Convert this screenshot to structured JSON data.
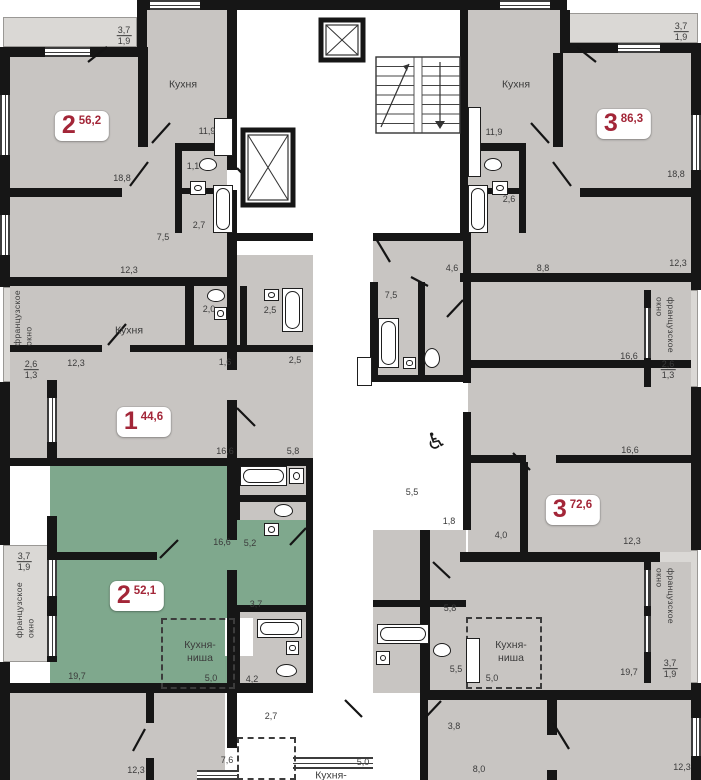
{
  "plan": {
    "type": "residential-floor-plan",
    "language": "ru",
    "width": 701,
    "height": 780
  },
  "colors": {
    "wall": "#161616",
    "floor_gray": "#c8c5c2",
    "floor_green": "#7fa88d",
    "balcony": "#dad8d5",
    "corridor": "#ffffff",
    "label_text": "#3b3b3b",
    "apartment_red": "#a32638"
  },
  "badges": [
    {
      "num": "2",
      "area": "56,2",
      "x": 82,
      "y": 126
    },
    {
      "num": "3",
      "area": "86,3",
      "x": 624,
      "y": 124
    },
    {
      "num": "1",
      "area": "44,6",
      "x": 144,
      "y": 422
    },
    {
      "num": "3",
      "area": "72,6",
      "x": 573,
      "y": 510
    },
    {
      "num": "2",
      "area": "52,1",
      "x": 137,
      "y": 596
    }
  ],
  "rooms": [
    {
      "t": "Кухня",
      "x": 183,
      "y": 85
    },
    {
      "t": "Кухня",
      "x": 516,
      "y": 85
    },
    {
      "t": "Кухня",
      "x": 129,
      "y": 331
    },
    {
      "t": "Кухня-\nниша",
      "x": 200,
      "y": 652
    },
    {
      "t": "Кухня-\nниша",
      "x": 511,
      "y": 652
    },
    {
      "t": "Кухня-",
      "x": 331,
      "y": 776
    }
  ],
  "dims": [
    {
      "t": "11,9",
      "x": 207,
      "y": 131
    },
    {
      "t": "18,8",
      "x": 122,
      "y": 178
    },
    {
      "t": "1,1",
      "x": 193,
      "y": 166
    },
    {
      "t": "2,7",
      "x": 199,
      "y": 225
    },
    {
      "t": "7,5",
      "x": 163,
      "y": 237
    },
    {
      "t": "12,3",
      "x": 129,
      "y": 270
    },
    {
      "t": "11,9",
      "x": 494,
      "y": 132
    },
    {
      "t": "18,8",
      "x": 676,
      "y": 174
    },
    {
      "t": "2,6",
      "x": 509,
      "y": 199
    },
    {
      "t": "12,3",
      "x": 678,
      "y": 263
    },
    {
      "t": "8,8",
      "x": 543,
      "y": 268
    },
    {
      "t": "4,6",
      "x": 452,
      "y": 268
    },
    {
      "t": "12,3",
      "x": 76,
      "y": 363
    },
    {
      "t": "2,0",
      "x": 209,
      "y": 309
    },
    {
      "t": "1,6",
      "x": 225,
      "y": 362
    },
    {
      "t": "2,5",
      "x": 270,
      "y": 310
    },
    {
      "t": "2,5",
      "x": 295,
      "y": 360
    },
    {
      "t": "16,6",
      "x": 225,
      "y": 451
    },
    {
      "t": "5,8",
      "x": 293,
      "y": 451
    },
    {
      "t": "16,6",
      "x": 629,
      "y": 356
    },
    {
      "t": "16,6",
      "x": 630,
      "y": 450
    },
    {
      "t": "7,5",
      "x": 391,
      "y": 295
    },
    {
      "t": "5,5",
      "x": 412,
      "y": 492
    },
    {
      "t": "1,8",
      "x": 449,
      "y": 521
    },
    {
      "t": "4,0",
      "x": 501,
      "y": 535
    },
    {
      "t": "12,3",
      "x": 632,
      "y": 541
    },
    {
      "t": "16,6",
      "x": 222,
      "y": 542
    },
    {
      "t": "19,7",
      "x": 77,
      "y": 676
    },
    {
      "t": "5,0",
      "x": 211,
      "y": 678
    },
    {
      "t": "5,2",
      "x": 250,
      "y": 543
    },
    {
      "t": "3,7",
      "x": 256,
      "y": 604
    },
    {
      "t": "4,2",
      "x": 252,
      "y": 679
    },
    {
      "t": "2,7",
      "x": 271,
      "y": 716
    },
    {
      "t": "5,8",
      "x": 450,
      "y": 608
    },
    {
      "t": "5,5",
      "x": 456,
      "y": 669
    },
    {
      "t": "19,7",
      "x": 629,
      "y": 672
    },
    {
      "t": "5,0",
      "x": 492,
      "y": 678
    },
    {
      "t": "3,8",
      "x": 454,
      "y": 726
    },
    {
      "t": "12,3",
      "x": 136,
      "y": 770
    },
    {
      "t": "7,6",
      "x": 227,
      "y": 760
    },
    {
      "t": "5,0",
      "x": 363,
      "y": 762
    },
    {
      "t": "8,0",
      "x": 479,
      "y": 769
    },
    {
      "t": "12,3",
      "x": 682,
      "y": 767
    }
  ],
  "fractions": [
    {
      "top": "3,7",
      "bot": "1,9",
      "x": 124,
      "y": 36
    },
    {
      "top": "3,7",
      "bot": "1,9",
      "x": 681,
      "y": 32
    },
    {
      "top": "2,6",
      "bot": "1,3",
      "x": 31,
      "y": 370
    },
    {
      "top": "2,6",
      "bot": "1,3",
      "x": 668,
      "y": 370
    },
    {
      "top": "3,7",
      "bot": "1,9",
      "x": 24,
      "y": 562
    },
    {
      "top": "3,7",
      "bot": "1,9",
      "x": 670,
      "y": 669
    }
  ],
  "vtexts": [
    {
      "t": "французское\nокно",
      "x": 12,
      "y": 290,
      "dir": "up"
    },
    {
      "t": "французское\nокно",
      "x": 14,
      "y": 582,
      "dir": "up"
    },
    {
      "t": "французское\nокно",
      "x": 653,
      "y": 297,
      "dir": "down"
    },
    {
      "t": "французское\nокно",
      "x": 653,
      "y": 568,
      "dir": "down"
    }
  ],
  "icons": [
    {
      "name": "wheelchair-icon",
      "glyph": "♿",
      "x": 436,
      "y": 441
    }
  ],
  "geometry": {
    "balconies": [
      [
        3,
        17,
        134,
        30
      ],
      [
        565,
        13,
        133,
        30
      ],
      [
        3,
        287,
        47,
        95
      ],
      [
        3,
        545,
        47,
        117
      ],
      [
        651,
        290,
        47,
        97
      ],
      [
        651,
        550,
        47,
        133
      ]
    ],
    "floors": [
      {
        "c": "g",
        "r": [
          10,
          47,
          217,
          230
        ]
      },
      {
        "c": "g",
        "r": [
          137,
          10,
          96,
          40
        ]
      },
      {
        "c": "g",
        "r": [
          466,
          10,
          96,
          43
        ]
      },
      {
        "c": "g",
        "r": [
          466,
          53,
          225,
          224
        ]
      },
      {
        "c": "g",
        "r": [
          10,
          286,
          303,
          172
        ]
      },
      {
        "c": "g",
        "r": [
          237,
          255,
          76,
          31
        ]
      },
      {
        "c": "g",
        "r": [
          468,
          282,
          223,
          270
        ]
      },
      {
        "c": "g",
        "r": [
          373,
          241,
          93,
          141
        ]
      },
      {
        "c": "g",
        "r": [
          373,
          530,
          93,
          163
        ]
      },
      {
        "c": "g",
        "r": [
          233,
          460,
          80,
          60
        ]
      },
      {
        "c": "g",
        "r": [
          233,
          612,
          77,
          71
        ]
      },
      {
        "c": "g",
        "r": [
          428,
          562,
          263,
          128
        ]
      },
      {
        "c": "g",
        "r": [
          10,
          693,
          217,
          87
        ]
      },
      {
        "c": "g",
        "r": [
          428,
          700,
          263,
          80
        ]
      },
      {
        "c": "n",
        "r": [
          50,
          465,
          183,
          218
        ]
      },
      {
        "c": "n",
        "r": [
          233,
          520,
          77,
          92
        ]
      },
      {
        "c": "w",
        "r": [
          233,
          10,
          227,
          223
        ]
      },
      {
        "c": "w",
        "r": [
          313,
          233,
          60,
          460
        ]
      },
      {
        "c": "w",
        "r": [
          345,
          382,
          118,
          148
        ]
      },
      {
        "c": "w",
        "r": [
          225,
          693,
          203,
          87
        ]
      },
      {
        "c": "w",
        "r": [
          225,
          618,
          28,
          38
        ]
      }
    ],
    "walls": [
      [
        0,
        47,
        10,
        240
      ],
      [
        0,
        382,
        10,
        163
      ],
      [
        0,
        662,
        10,
        118
      ],
      [
        0,
        47,
        140,
        10
      ],
      [
        137,
        10,
        10,
        47
      ],
      [
        137,
        0,
        430,
        10
      ],
      [
        560,
        10,
        10,
        43
      ],
      [
        560,
        43,
        141,
        10
      ],
      [
        691,
        43,
        10,
        247
      ],
      [
        691,
        387,
        10,
        163
      ],
      [
        691,
        683,
        10,
        97
      ],
      [
        227,
        10,
        10,
        160
      ],
      [
        227,
        190,
        10,
        180
      ],
      [
        227,
        400,
        10,
        140
      ],
      [
        227,
        570,
        10,
        123
      ],
      [
        227,
        693,
        10,
        55
      ],
      [
        460,
        10,
        8,
        223
      ],
      [
        463,
        233,
        8,
        150
      ],
      [
        463,
        412,
        8,
        118
      ],
      [
        420,
        530,
        10,
        163
      ],
      [
        420,
        693,
        8,
        87
      ],
      [
        0,
        277,
        237,
        9
      ],
      [
        460,
        273,
        241,
        9
      ],
      [
        10,
        458,
        303,
        8
      ],
      [
        0,
        683,
        313,
        10
      ],
      [
        460,
        552,
        200,
        10
      ],
      [
        420,
        690,
        281,
        10
      ],
      [
        237,
        233,
        76,
        8
      ],
      [
        373,
        233,
        90,
        8
      ],
      [
        138,
        47,
        10,
        100
      ],
      [
        175,
        143,
        58,
        8
      ],
      [
        175,
        151,
        7,
        82
      ],
      [
        182,
        188,
        51,
        6
      ],
      [
        0,
        188,
        122,
        9
      ],
      [
        553,
        53,
        10,
        94
      ],
      [
        466,
        143,
        60,
        8
      ],
      [
        519,
        151,
        7,
        82
      ],
      [
        466,
        188,
        53,
        6
      ],
      [
        580,
        188,
        121,
        9
      ],
      [
        185,
        286,
        9,
        60
      ],
      [
        10,
        345,
        92,
        7
      ],
      [
        130,
        345,
        183,
        7
      ],
      [
        240,
        286,
        7,
        59
      ],
      [
        466,
        360,
        225,
        8
      ],
      [
        466,
        455,
        60,
        8
      ],
      [
        556,
        455,
        135,
        8
      ],
      [
        520,
        462,
        8,
        90
      ],
      [
        370,
        282,
        8,
        100
      ],
      [
        370,
        375,
        96,
        7
      ],
      [
        418,
        282,
        7,
        93
      ],
      [
        57,
        552,
        100,
        8
      ],
      [
        306,
        460,
        7,
        233
      ],
      [
        233,
        460,
        7,
        60
      ],
      [
        237,
        495,
        73,
        7
      ],
      [
        233,
        612,
        7,
        81
      ],
      [
        233,
        605,
        77,
        7
      ],
      [
        146,
        693,
        8,
        30
      ],
      [
        146,
        758,
        8,
        22
      ],
      [
        547,
        690,
        10,
        45
      ],
      [
        547,
        770,
        10,
        10
      ],
      [
        373,
        600,
        93,
        7
      ],
      [
        47,
        380,
        10,
        80
      ],
      [
        47,
        516,
        10,
        146
      ],
      [
        644,
        290,
        7,
        97
      ],
      [
        644,
        553,
        7,
        130
      ]
    ],
    "windows": [
      {
        "o": "h",
        "r": [
          45,
          47,
          45,
          10
        ]
      },
      {
        "o": "h",
        "r": [
          150,
          0,
          50,
          10
        ]
      },
      {
        "o": "h",
        "r": [
          500,
          0,
          50,
          10
        ]
      },
      {
        "o": "h",
        "r": [
          618,
          43,
          42,
          10
        ]
      },
      {
        "o": "h",
        "r": [
          197,
          770,
          42,
          10
        ]
      },
      {
        "o": "h",
        "r": [
          293,
          757,
          80,
          12
        ]
      },
      {
        "o": "v",
        "r": [
          0,
          95,
          10,
          60
        ]
      },
      {
        "o": "v",
        "r": [
          0,
          215,
          10,
          40
        ]
      },
      {
        "o": "v",
        "r": [
          691,
          115,
          10,
          55
        ]
      },
      {
        "o": "v",
        "r": [
          47,
          398,
          10,
          44
        ]
      },
      {
        "o": "v",
        "r": [
          47,
          560,
          10,
          36
        ]
      },
      {
        "o": "v",
        "r": [
          47,
          616,
          10,
          40
        ]
      },
      {
        "o": "v",
        "r": [
          644,
          308,
          7,
          50
        ]
      },
      {
        "o": "v",
        "r": [
          644,
          570,
          7,
          36
        ]
      },
      {
        "o": "v",
        "r": [
          644,
          616,
          7,
          36
        ]
      },
      {
        "o": "v",
        "r": [
          691,
          718,
          10,
          38
        ]
      }
    ],
    "niches": [
      [
        161,
        618,
        74,
        71
      ],
      [
        466,
        617,
        76,
        72
      ],
      [
        237,
        737,
        59,
        43
      ]
    ],
    "fixtures": [
      {
        "t": "tubv",
        "r": [
          213,
          185,
          20,
          48
        ]
      },
      {
        "t": "tubv",
        "r": [
          468,
          185,
          20,
          48
        ]
      },
      {
        "t": "tubv",
        "r": [
          282,
          288,
          21,
          44
        ]
      },
      {
        "t": "tubv",
        "r": [
          378,
          318,
          21,
          50
        ]
      },
      {
        "t": "tubh",
        "r": [
          240,
          466,
          47,
          20
        ]
      },
      {
        "t": "tubh",
        "r": [
          257,
          619,
          45,
          19
        ]
      },
      {
        "t": "tubh",
        "r": [
          377,
          624,
          52,
          20
        ]
      },
      {
        "t": "wc",
        "r": [
          199,
          158,
          18,
          13
        ]
      },
      {
        "t": "wc",
        "r": [
          484,
          158,
          18,
          13
        ]
      },
      {
        "t": "wc",
        "r": [
          207,
          289,
          18,
          13
        ]
      },
      {
        "t": "wc",
        "r": [
          424,
          348,
          16,
          20
        ]
      },
      {
        "t": "wc",
        "r": [
          274,
          504,
          19,
          13
        ]
      },
      {
        "t": "wc",
        "r": [
          276,
          664,
          21,
          13
        ]
      },
      {
        "t": "wc",
        "r": [
          433,
          643,
          18,
          14
        ]
      },
      {
        "t": "sink",
        "r": [
          190,
          181,
          16,
          14
        ]
      },
      {
        "t": "sink",
        "r": [
          492,
          181,
          16,
          14
        ]
      },
      {
        "t": "sink",
        "r": [
          214,
          307,
          13,
          13
        ]
      },
      {
        "t": "sink",
        "r": [
          264,
          289,
          15,
          12
        ]
      },
      {
        "t": "sink",
        "r": [
          403,
          357,
          13,
          12
        ]
      },
      {
        "t": "sink",
        "r": [
          289,
          468,
          15,
          16
        ]
      },
      {
        "t": "sink",
        "r": [
          264,
          523,
          15,
          13
        ]
      },
      {
        "t": "sink",
        "r": [
          286,
          641,
          13,
          14
        ]
      },
      {
        "t": "sink",
        "r": [
          376,
          651,
          14,
          14
        ]
      },
      {
        "t": "counter",
        "r": [
          214,
          118,
          19,
          38
        ]
      },
      {
        "t": "counter",
        "r": [
          468,
          107,
          13,
          70
        ]
      },
      {
        "t": "counter",
        "r": [
          357,
          357,
          15,
          29
        ]
      },
      {
        "t": "counter",
        "r": [
          466,
          638,
          14,
          45
        ]
      }
    ],
    "elevators": [
      [
        321,
        20,
        42,
        40
      ],
      [
        243,
        130,
        50,
        75
      ]
    ],
    "stairs": {
      "x": 376,
      "y": 57,
      "w": 84,
      "h": 76
    },
    "doors": [
      [
        88,
        62,
        107,
        47
      ],
      [
        152,
        143,
        170,
        123
      ],
      [
        130,
        186,
        148,
        162
      ],
      [
        237,
        168,
        254,
        186
      ],
      [
        596,
        62,
        577,
        47
      ],
      [
        549,
        143,
        531,
        123
      ],
      [
        571,
        186,
        553,
        162
      ],
      [
        463,
        300,
        447,
        317
      ],
      [
        375,
        237,
        390,
        262
      ],
      [
        411,
        277,
        428,
        286
      ],
      [
        108,
        345,
        126,
        324
      ],
      [
        237,
        408,
        255,
        426
      ],
      [
        160,
        558,
        178,
        540
      ],
      [
        306,
        528,
        290,
        545
      ],
      [
        530,
        470,
        513,
        453
      ],
      [
        433,
        562,
        450,
        578
      ],
      [
        425,
        718,
        441,
        701
      ],
      [
        133,
        751,
        145,
        729
      ],
      [
        553,
        723,
        569,
        749
      ],
      [
        345,
        700,
        362,
        717
      ]
    ]
  }
}
